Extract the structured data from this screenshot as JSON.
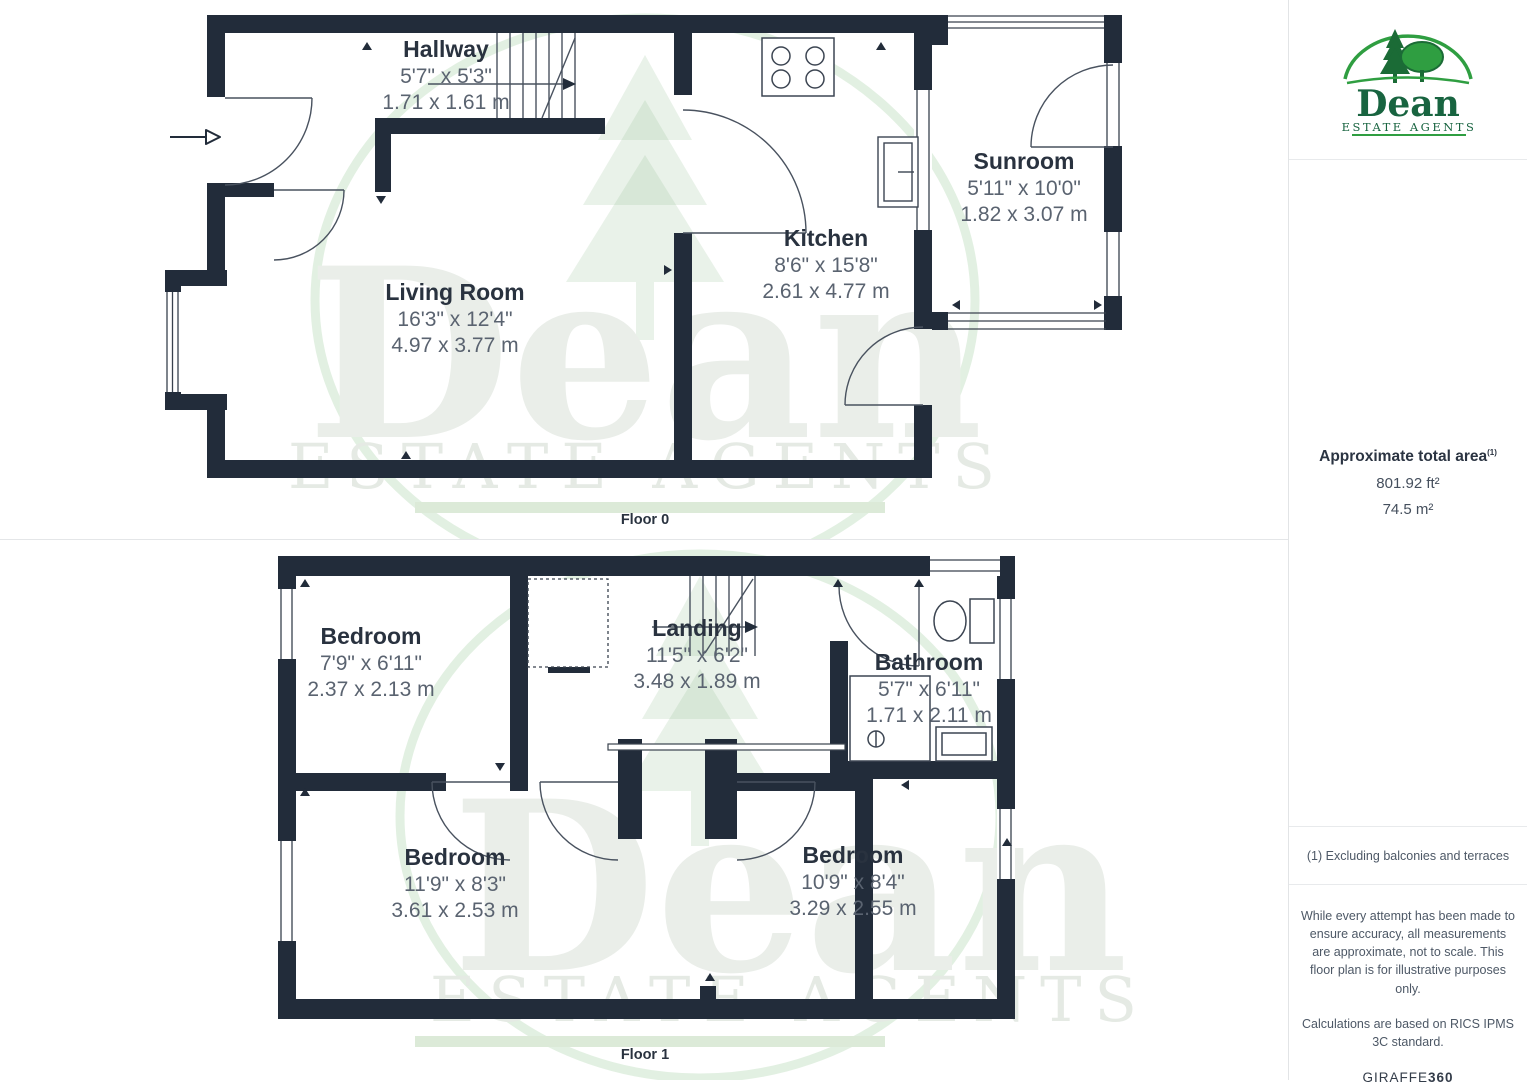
{
  "brand": {
    "name": "Dean",
    "subtitle": "ESTATE AGENTS"
  },
  "watermark": {
    "name": "Dean",
    "subtitle": "ESTATE AGENTS"
  },
  "floors": [
    {
      "label": "Floor 0",
      "rooms": [
        {
          "name": "Hallway",
          "imperial": "5'7\" x 5'3\"",
          "metric": "1.71 x 1.61 m"
        },
        {
          "name": "Living Room",
          "imperial": "16'3\" x 12'4\"",
          "metric": "4.97 x 3.77 m"
        },
        {
          "name": "Kitchen",
          "imperial": "8'6\" x 15'8\"",
          "metric": "2.61 x 4.77 m"
        },
        {
          "name": "Sunroom",
          "imperial": "5'11\" x 10'0\"",
          "metric": "1.82 x 3.07 m"
        }
      ]
    },
    {
      "label": "Floor 1",
      "rooms": [
        {
          "name": "Bedroom",
          "imperial": "7'9\" x 6'11\"",
          "metric": "2.37 x 2.13 m"
        },
        {
          "name": "Landing",
          "imperial": "11'5\" x 6'2\"",
          "metric": "3.48 x 1.89 m"
        },
        {
          "name": "Bathroom",
          "imperial": "5'7\" x 6'11\"",
          "metric": "1.71 x 2.11 m"
        },
        {
          "name": "Bedroom",
          "imperial": "11'9\" x 8'3\"",
          "metric": "3.61 x 2.53 m"
        },
        {
          "name": "Bedroom",
          "imperial": "10'9\" x 8'4\"",
          "metric": "3.29 x 2.55 m"
        }
      ]
    }
  ],
  "sidebar": {
    "area_title": "Approximate total area",
    "area_sup": "(1)",
    "area_ft": "801.92 ft²",
    "area_m": "74.5 m²",
    "footnote": "(1) Excluding balconies and terraces",
    "disclaimer1": "While every attempt has been made to ensure accuracy, all measurements are approximate, not to scale. This floor plan is for illustrative purposes only.",
    "disclaimer2": "Calculations are based on RICS IPMS 3C standard.",
    "brand_footer": "GIRAFFE",
    "brand_footer_bold": "360"
  },
  "colors": {
    "wall": "#222c3a",
    "room_name": "#29323f",
    "dimension": "#5a6370",
    "logo_green_dark": "#186440",
    "logo_green_bright": "#2f9e41",
    "watermark_bar": "#dcead8"
  }
}
